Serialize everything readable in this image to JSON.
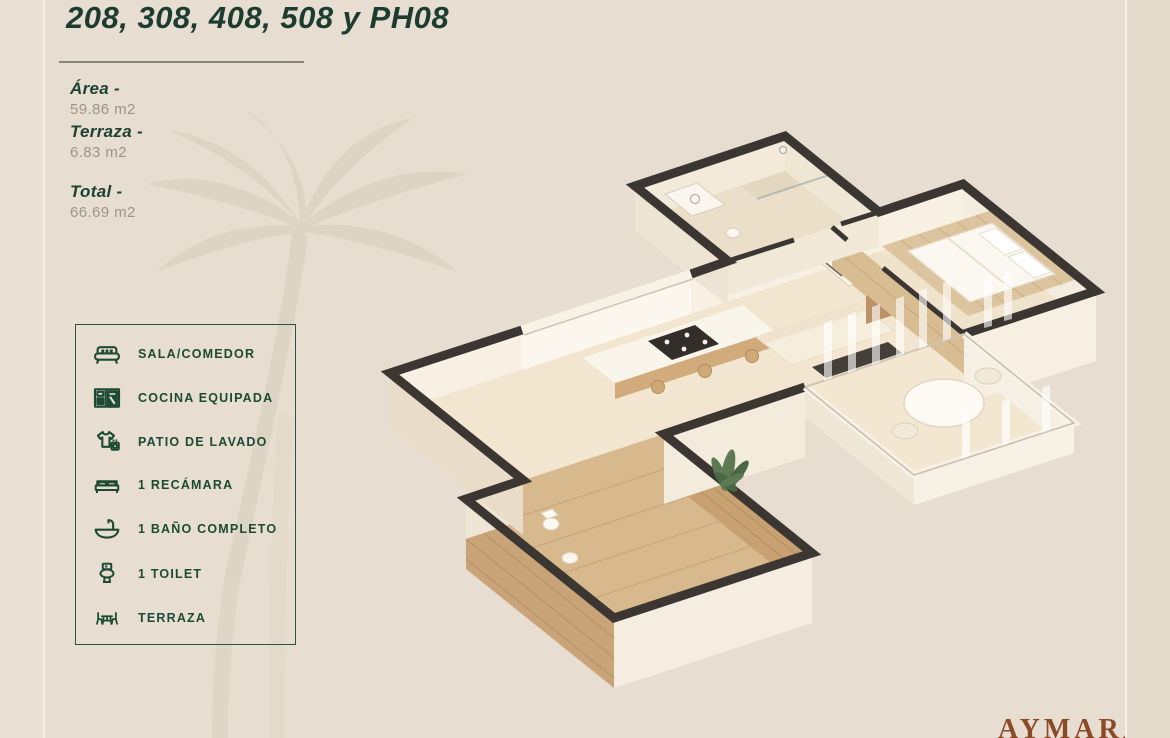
{
  "page": {
    "background": "#e7ded1",
    "edge_strip_color": "#e4dbcd"
  },
  "header": {
    "title": "208, 308, 408, 508 y PH08"
  },
  "specs": {
    "area_label": "Área -",
    "area_value": "59.86 m2",
    "terraza_label": "Terraza -",
    "terraza_value": "6.83 m2",
    "total_label": "Total -",
    "total_value": "66.69 m2"
  },
  "legend": {
    "items": [
      {
        "icon": "sofa-icon",
        "label": "SALA/COMEDOR"
      },
      {
        "icon": "kitchen-icon",
        "label": "COCINA EQUIPADA"
      },
      {
        "icon": "laundry-icon",
        "label": "PATIO DE LAVADO"
      },
      {
        "icon": "bed-icon",
        "label": "1 RECÁMARA"
      },
      {
        "icon": "sink-icon",
        "label": "1 BAÑO COMPLETO"
      },
      {
        "icon": "toilet-icon",
        "label": "1 TOILET"
      },
      {
        "icon": "terrace-icon",
        "label": "TERRAZA"
      }
    ]
  },
  "floorplan": {
    "type": "3d-isometric-render"
  },
  "footer": {
    "brand": "AYMARA"
  },
  "colors": {
    "title_green": "#1c3b31",
    "accent_green": "#1c4a33",
    "text_gray": "#9a958a",
    "brand_brown": "#8b4a26",
    "wall_dark": "#3b3632",
    "wood": "#c9a478"
  }
}
